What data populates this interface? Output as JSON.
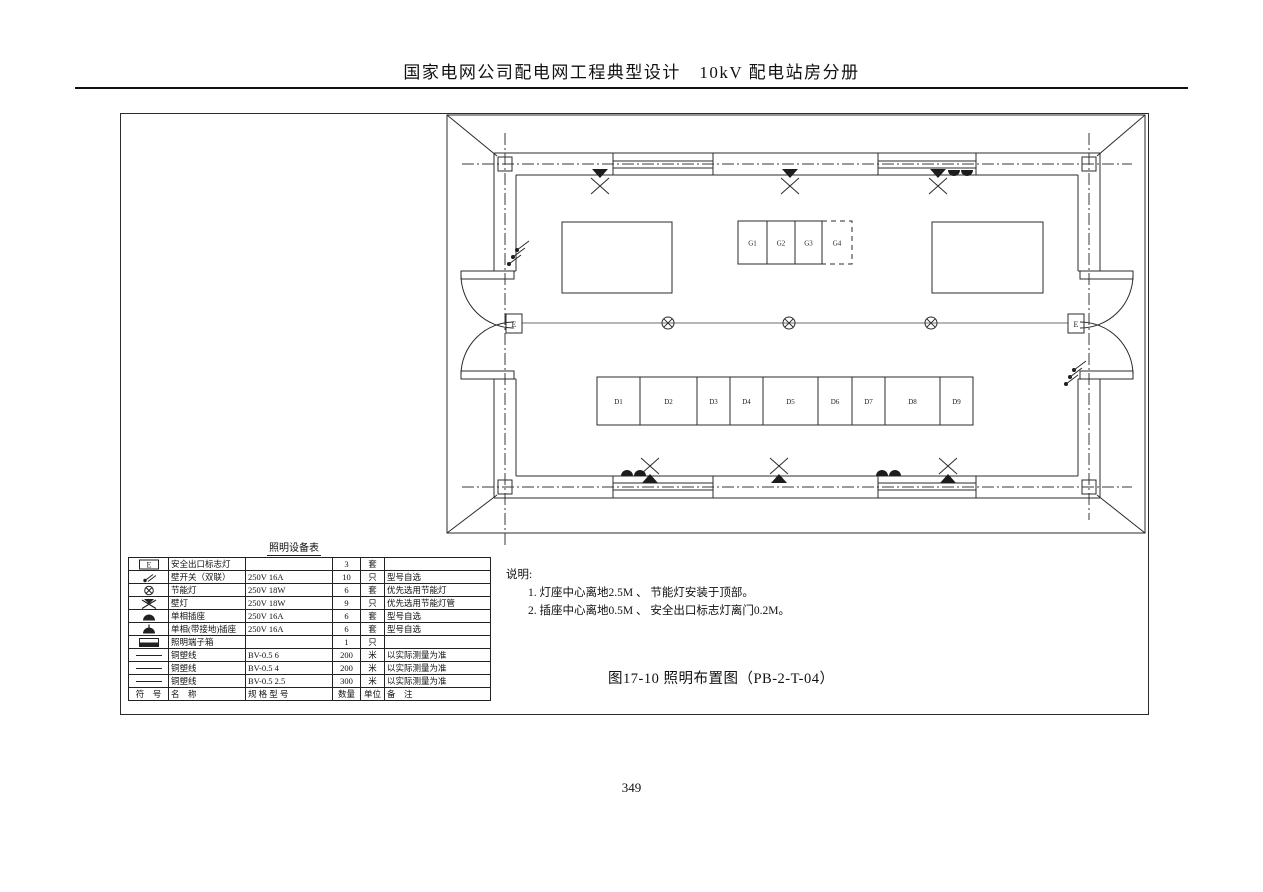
{
  "colors": {
    "line": "#2b2b2b",
    "ceiling_line": "#8a8a8a"
  },
  "page": {
    "header_title": "国家电网公司配电网工程典型设计　10kV 配电站房分册",
    "page_number": "349"
  },
  "figure": {
    "caption": "图17-10 照明布置图（PB-2-T-04）"
  },
  "notes": {
    "heading": "说明:",
    "item1": "1.  灯座中心离地2.5M 、 节能灯安装于顶部。",
    "item2": "2.  插座中心离地0.5M 、 安全出口标志灯离门0.2M。"
  },
  "plan": {
    "exit_sign_label": "E",
    "g_cells": [
      "G1",
      "G2",
      "G3",
      "G4"
    ],
    "d_cells": [
      "D1",
      "D2",
      "D3",
      "D4",
      "D5",
      "D6",
      "D7",
      "D8",
      "D9"
    ]
  },
  "equipment_table": {
    "title": "照明设备表",
    "rows": [
      {
        "icon": "exit-sign",
        "name": "安全出口标志灯",
        "spec": "",
        "qty": "3",
        "unit": "套",
        "note": ""
      },
      {
        "icon": "wall-switch",
        "name": "壁开关（双联）",
        "spec": "250V 16A",
        "qty": "10",
        "unit": "只",
        "note": "型号自选"
      },
      {
        "icon": "ceiling-lamp",
        "name": "节能灯",
        "spec": "250V 18W",
        "qty": "6",
        "unit": "套",
        "note": "优先选用节能灯"
      },
      {
        "icon": "wall-lamp",
        "name": "壁灯",
        "spec": "250V 18W",
        "qty": "9",
        "unit": "只",
        "note": "优先选用节能灯管"
      },
      {
        "icon": "socket",
        "name": "单相插座",
        "spec": "250V 16A",
        "qty": "6",
        "unit": "套",
        "note": "型号自选"
      },
      {
        "icon": "grounded-socket",
        "name": "单相(带接地)插座",
        "spec": "250V 16A",
        "qty": "6",
        "unit": "套",
        "note": "型号自选"
      },
      {
        "icon": "terminal-box",
        "name": "照明端子箱",
        "spec": "",
        "qty": "1",
        "unit": "只",
        "note": ""
      },
      {
        "icon": "wire",
        "name": "铜塑线",
        "spec": "BV-0.5  6",
        "qty": "200",
        "unit": "米",
        "note": "以实际测量为准"
      },
      {
        "icon": "wire",
        "name": "铜塑线",
        "spec": "BV-0.5  4",
        "qty": "200",
        "unit": "米",
        "note": "以实际测量为准"
      },
      {
        "icon": "wire",
        "name": "铜塑线",
        "spec": "BV-0.5  2.5",
        "qty": "300",
        "unit": "米",
        "note": "以实际测量为准"
      }
    ],
    "footer": {
      "symbol": "符　号",
      "name": "名　称",
      "spec": "规 格 型 号",
      "qty": "数量",
      "unit": "单位",
      "note": "备　注"
    }
  }
}
